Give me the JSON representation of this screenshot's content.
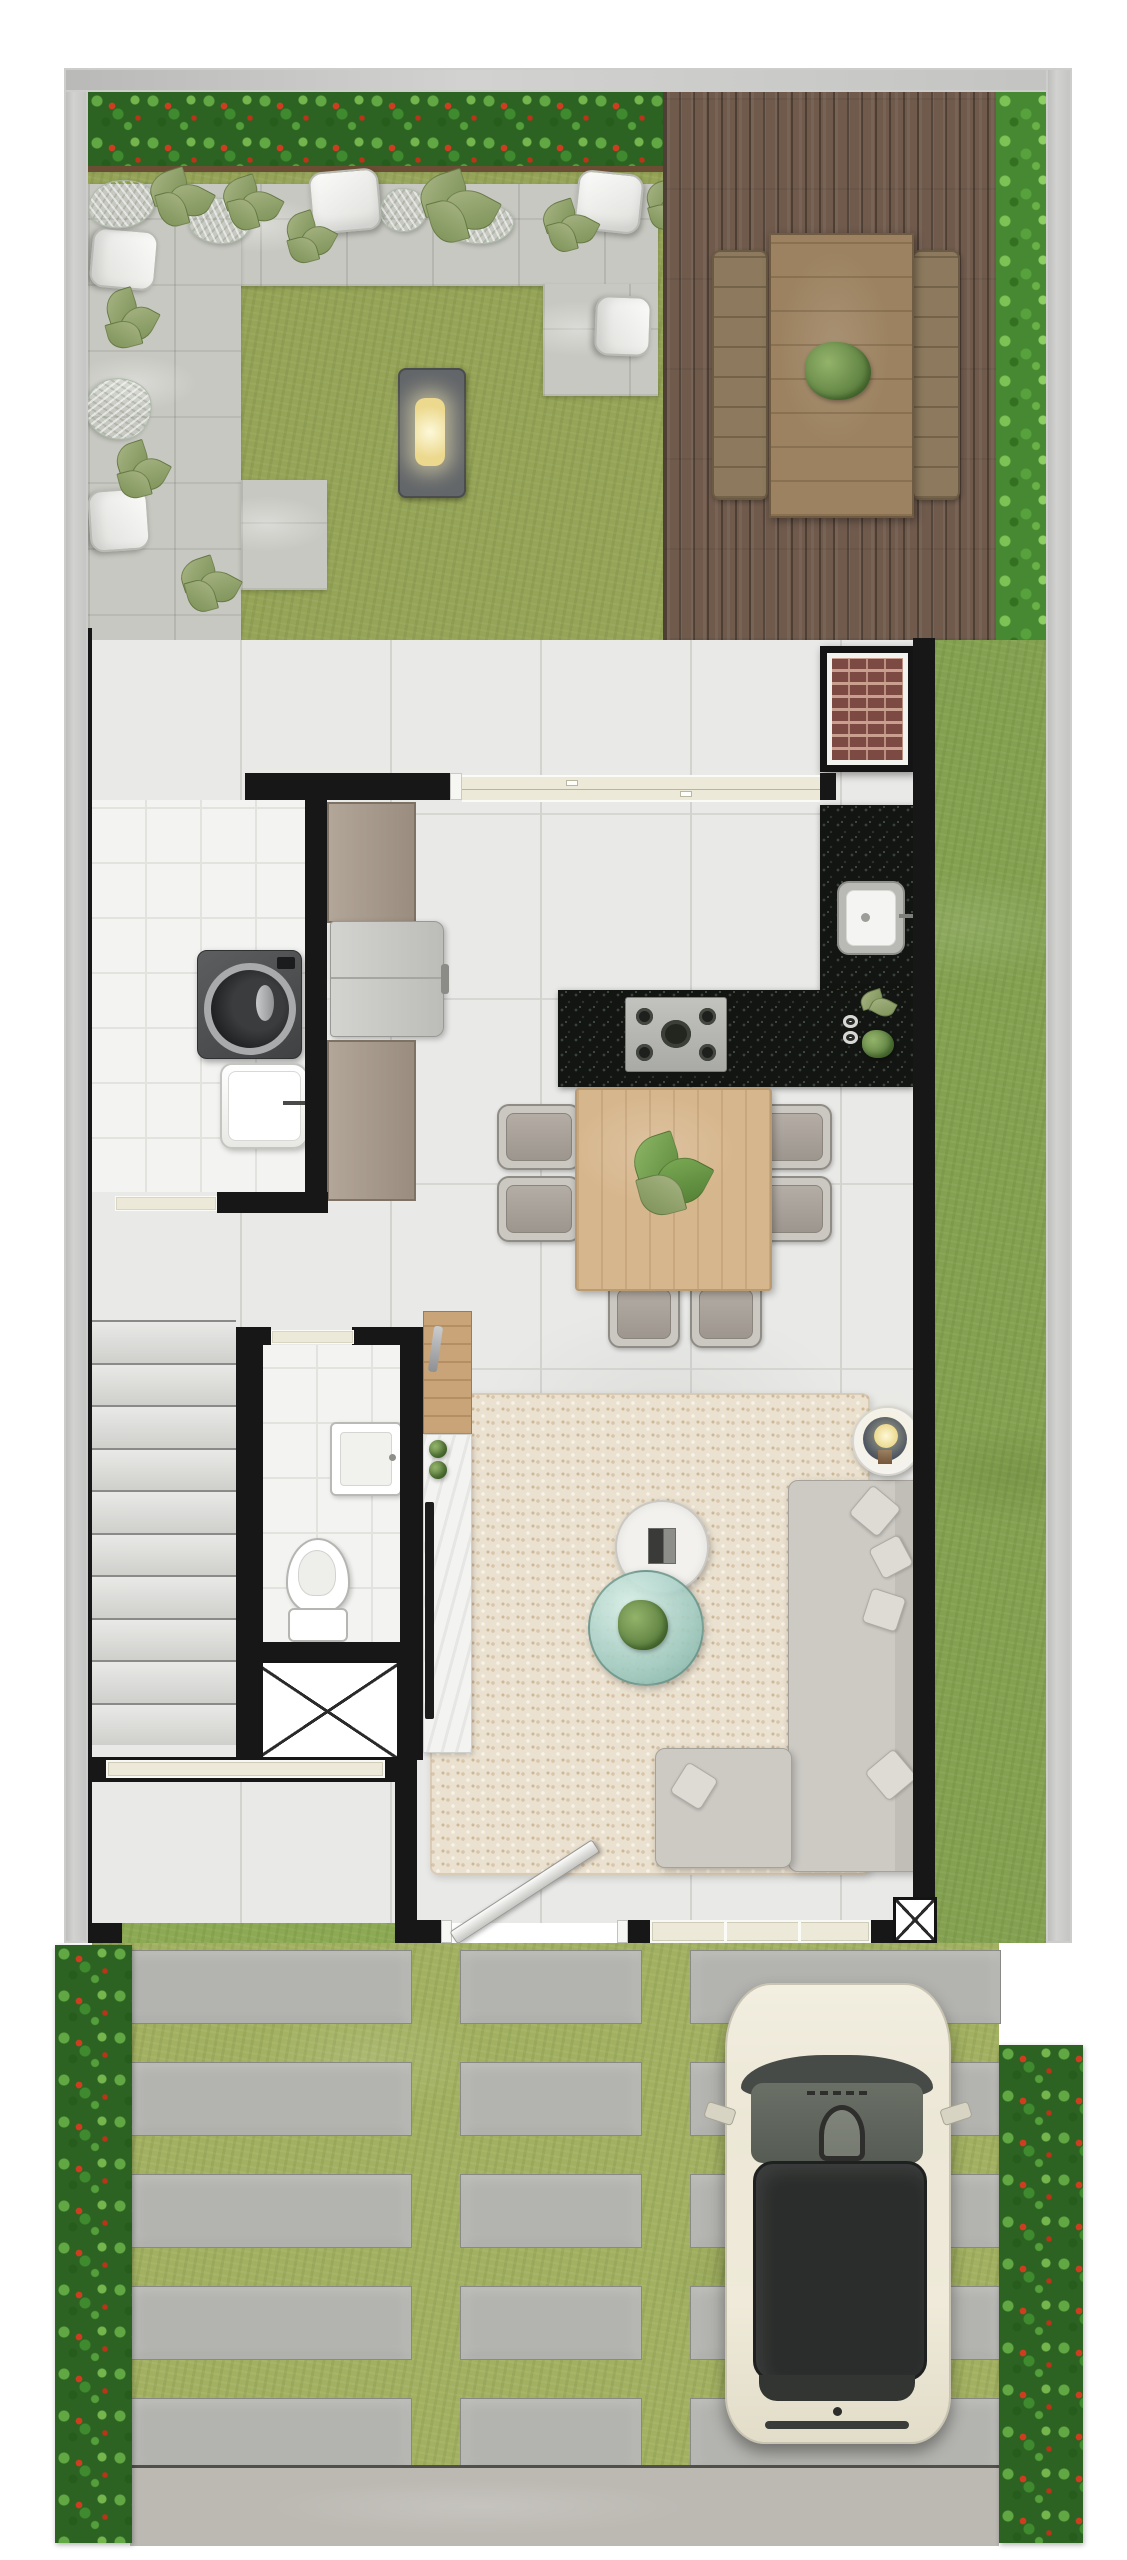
{
  "meta": {
    "type": "architectural-floor-plan",
    "view": "top-down",
    "description": "Ground-floor plan of a narrow townhouse lot: back garden with deck, open gourmet terrace with barbecue, kitchen/dining, laundry, bathroom, stairs, living room, front garden and driveway with parked car"
  },
  "colors": {
    "wall": "#171717",
    "frame": "#c8c8c6",
    "floor": "#e9e9e7",
    "floor_white": "#f3f3f1",
    "window": "#ece9d8",
    "lawn_back": "#95a457",
    "lawn_side": "#83a150",
    "lawn_front": "#8ca953",
    "lawn_drive": "#a2b161",
    "hedge": "#2d6322",
    "hedge_red": "#cf3d20",
    "patio": "#c7c8c1",
    "deck": "#6f5a4c",
    "paver": "#b3b3af",
    "street": "#bcb9b3",
    "rug": "#ebe1d0",
    "counter": "#131512",
    "wood": "#d6b68c",
    "sofa": "#cdcac4",
    "brick": "#7c4a42",
    "car_body": "#efead9",
    "car_glass": "#2b2d2c",
    "lamp_navy": "#2e3950",
    "teal_glass": "#9ec9bf"
  },
  "counts": {
    "stair_treads": 10,
    "paver_rows": 5,
    "paver_columns": 3,
    "dining_chairs": 6,
    "deck_benches": 2,
    "white_lounge_pads": 5,
    "driveway_hedges": 2
  },
  "labels": {
    "plan": "ground floor plan",
    "frame": "lot boundary wall",
    "backyard": "back garden lawn",
    "hedge_top": "flowering hedge",
    "patio": "concrete garden patio",
    "lounge_pad": "white lounge cushion",
    "crinkle_pad": "quilted garden cushion",
    "garden_plant": "garden plant",
    "ground_light": "recessed ground light",
    "deck": "wood deck",
    "deck_table": "outdoor dining table",
    "deck_bench": "deck bench",
    "deck_plant": "table centerpiece plant",
    "side_bush": "side hedge",
    "terrace": "covered gourmet terrace",
    "grill": "brick barbecue grill",
    "sliding_door": "sliding glass door",
    "kitchen_counter": "black granite counter",
    "kitchen_sink": "kitchen sink",
    "cooktop": "gas cooktop",
    "kitchen_plant": "counter plant",
    "dish": "bowl",
    "dining_table": "wood dining table",
    "dining_chair": "dining chair",
    "table_plant": "table centerpiece",
    "laundry": "laundry room",
    "washer": "washing machine",
    "laundry_tub": "laundry sink",
    "cabinet": "storage cabinet",
    "fridge": "refrigerator",
    "service_door": "service door opening",
    "stairs": "staircase",
    "bathroom": "bathroom",
    "bath_sink": "wall-hung basin",
    "toilet": "toilet",
    "bath_door": "bathroom door opening",
    "shaft": "elevator shaft / void",
    "south_window": "window",
    "tv_console": "tv console",
    "tv": "television",
    "wood_shelf": "wood counter shelf",
    "living_room": "living room",
    "rug": "shag rug",
    "sofa": "l-shaped sofa",
    "pillow": "throw pillow",
    "coffee_table": "round coffee table",
    "glass_table": "round glass table",
    "lamp_table": "side table with lamp",
    "front_door": "front door",
    "door_leaf": "open door leaf",
    "front_window": "front window",
    "ac_box": "utility box",
    "front_garden": "front garden",
    "driveway": "driveway",
    "paver": "concrete paver",
    "street": "sidewalk",
    "car": "parked car",
    "mirror": "side mirror",
    "lawn_strip": "side lawn strip"
  }
}
